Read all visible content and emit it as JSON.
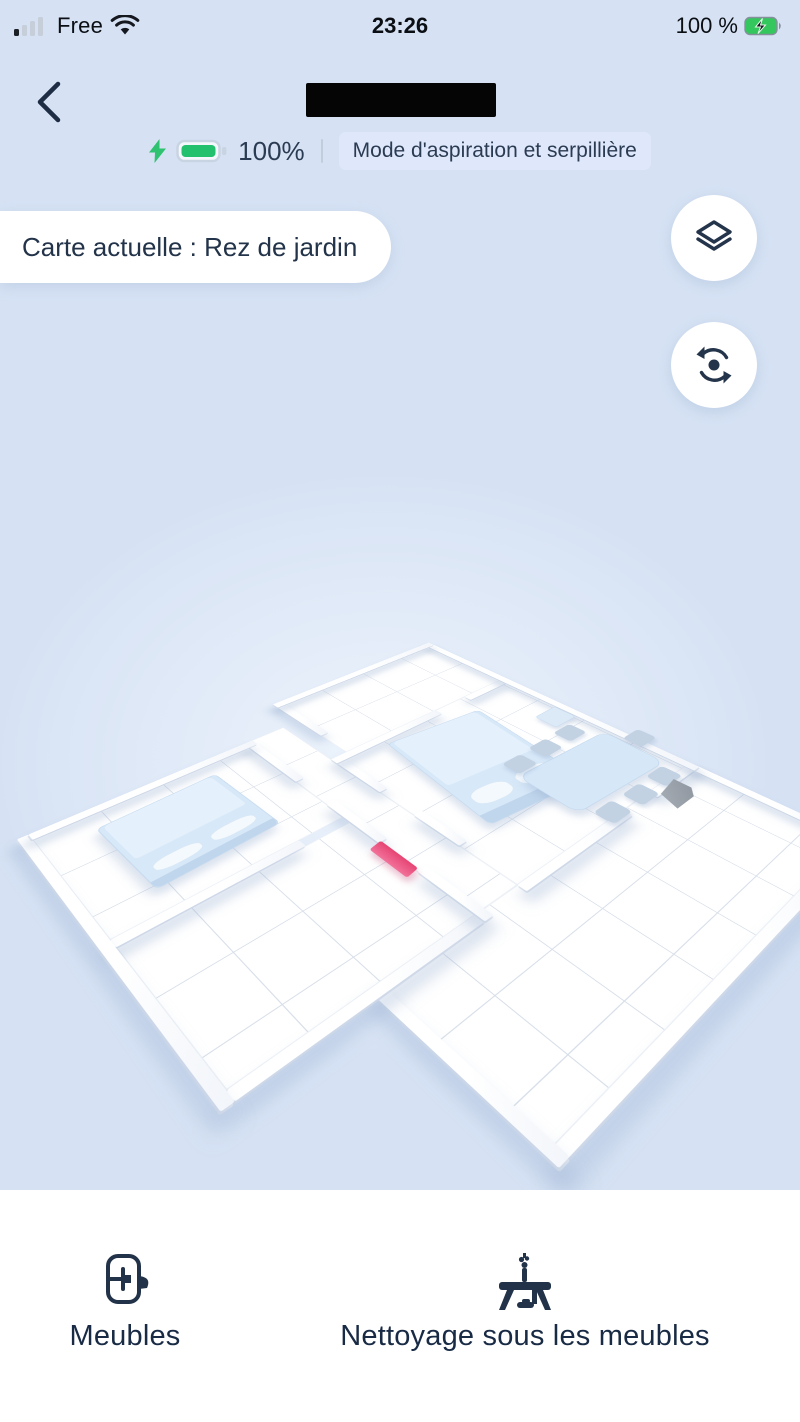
{
  "status_bar": {
    "carrier": "Free",
    "time": "23:26",
    "battery": "100 %"
  },
  "header": {
    "battery_percent": "100%",
    "mode_badge": "Mode d'aspiration et serpillière"
  },
  "map": {
    "pill": "Carte actuelle : Rez de jardin"
  },
  "bottom_nav": {
    "items": [
      {
        "label": "Meubles"
      },
      {
        "label": "Nettoyage sous les meubles"
      }
    ]
  },
  "colors": {
    "background_blue": "#d6e2f4",
    "badge_bg": "#dfe8fb",
    "battery_green": "#27c26e",
    "pink_marker": "#e8527e",
    "dock_gray": "#99a1aa",
    "text_dark": "#22334a",
    "icon_navy": "#24344b"
  }
}
